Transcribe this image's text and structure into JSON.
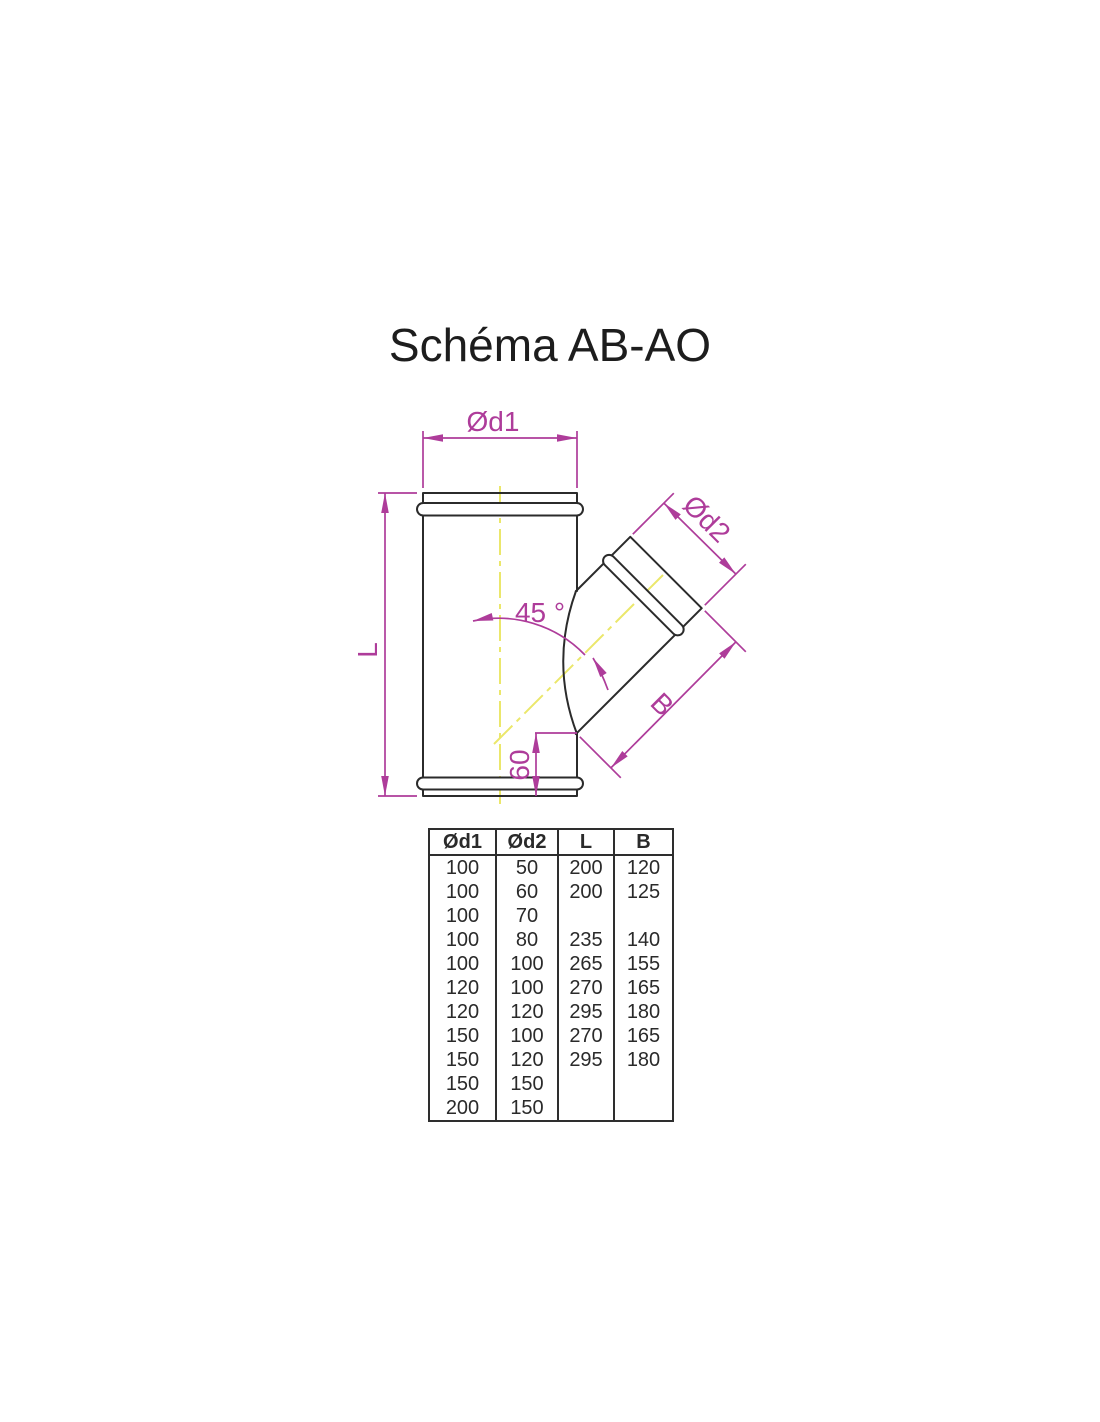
{
  "title": "Schéma AB-AO",
  "diagram": {
    "labels": {
      "d1": "Ød1",
      "d2": "Ød2",
      "length": "L",
      "branch": "B",
      "angle": "45 °",
      "offset": "60"
    },
    "colors": {
      "outline": "#2b2b2b",
      "dimension": "#ae3c9a",
      "centerline": "#ebe76b"
    }
  },
  "table": {
    "headers": [
      "Ød1",
      "Ød2",
      "L",
      "B"
    ],
    "rows": [
      [
        "100",
        "50",
        "200",
        "120"
      ],
      [
        "100",
        "60",
        "200",
        "125"
      ],
      [
        "100",
        "70",
        "",
        ""
      ],
      [
        "100",
        "80",
        "235",
        "140"
      ],
      [
        "100",
        "100",
        "265",
        "155"
      ],
      [
        "120",
        "100",
        "270",
        "165"
      ],
      [
        "120",
        "120",
        "295",
        "180"
      ],
      [
        "150",
        "100",
        "270",
        "165"
      ],
      [
        "150",
        "120",
        "295",
        "180"
      ],
      [
        "150",
        "150",
        "",
        ""
      ],
      [
        "200",
        "150",
        "",
        ""
      ]
    ]
  }
}
